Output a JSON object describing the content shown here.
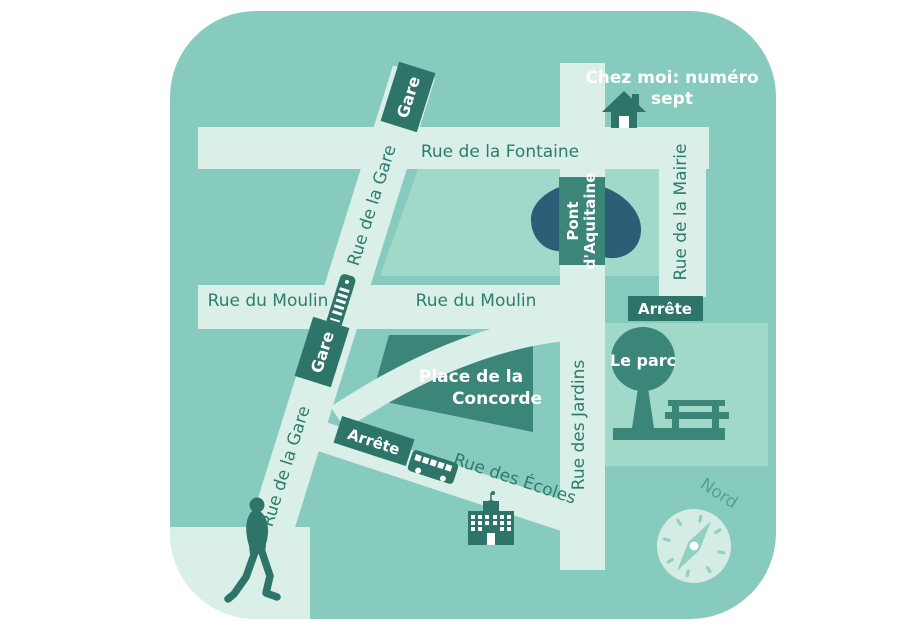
{
  "map": {
    "home_note": {
      "line1": "Chez moi: numéro",
      "line2": "sept"
    },
    "streets": {
      "fontaine": "Rue de la Fontaine",
      "gare_upper": "Rue de la Gare",
      "gare_lower": "Rue de la Gare",
      "moulin_left": "Rue du Moulin",
      "moulin_right": "Rue du Moulin",
      "mairie": "Rue de la Mairie",
      "jardins": "Rue des Jardins",
      "ecoles": "Rue des Écoles"
    },
    "markers": {
      "gare_top": "Gare",
      "gare_mid": "Gare",
      "pont": {
        "line1": "Pont",
        "line2": "d'Aquitaine"
      },
      "place": {
        "line1": "Place de la",
        "line2": "Concorde"
      },
      "parc": "Le parc",
      "arrete_parc": "Arrête",
      "arrete_bus": "Arrête",
      "nord": "Nord"
    },
    "colors": {
      "page_bg": "#ffffff",
      "card_bg": "#87cbbe",
      "street": "#d9efe8",
      "block": "#a0d8ca",
      "dark": "#2e7468",
      "mid_dark": "#3b8579",
      "pond": "#2d5e78",
      "street_text": "#2e7c6e",
      "nord_text": "#55a294",
      "compass_face": "#d5ece5",
      "compass_glyph": "#8ed0c2",
      "white_text": "#ffffff"
    }
  }
}
